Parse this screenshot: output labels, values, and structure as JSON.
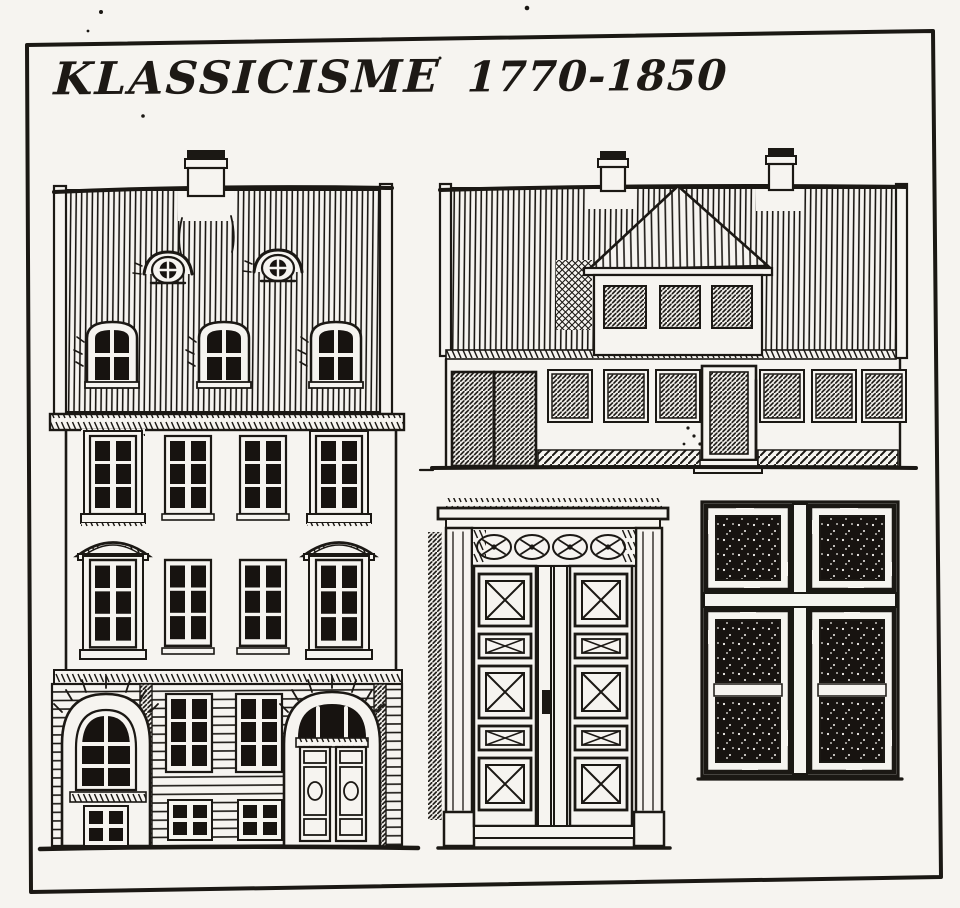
{
  "title": {
    "style_name": "KLASSICISME",
    "period": "1770-1850",
    "full": "KLASSICISME 1770-1850"
  },
  "palette": {
    "ink": "#1b1814",
    "paper": "#f6f4f0"
  },
  "illustrations": {
    "townhouse": "three-storey townhouse facade",
    "house": "single-storey house with pedimented wall dormer",
    "door": "panelled double entrance door",
    "window": "four-casement cross-post window"
  }
}
